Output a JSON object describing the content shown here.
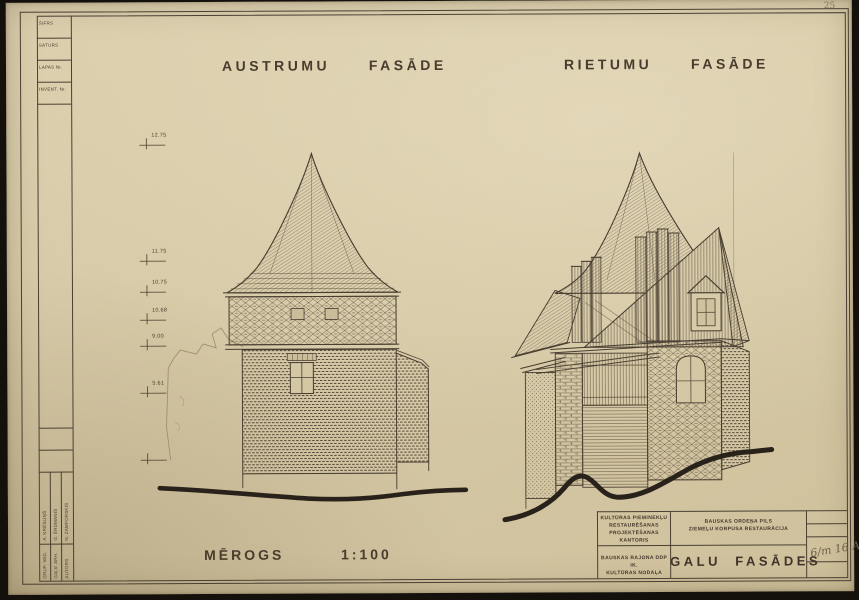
{
  "page": {
    "sheet_number": "25"
  },
  "colors": {
    "paper": "#d7cba9",
    "ink": "#46392b",
    "ground": "#29221a"
  },
  "corner_table": {
    "labels": [
      "ŠIFRS",
      "SATURS",
      "LAPAS Nr.",
      "INVENT. Nr."
    ]
  },
  "facade_titles": {
    "left": "AUSTRUMU  FASĀDE",
    "right": "RIETUMU  FASĀDE"
  },
  "scale_label": "MĒROGS   1:100",
  "elevations": [
    "12.75",
    "11.75",
    "10.75",
    "10.68",
    "9.00",
    "5.61"
  ],
  "title_block": {
    "office": "KULTŪRAS PIEMINEKĻU\nRESTAURĒŠANAS\nPROJEKTĒŠANAS\nKANTORIS",
    "project": "BAUSKAS  ORDEŅA  PILS\nZIEMEĻU KORPUSA RESTAURĀCIJA",
    "client": "BAUSKAS RAJONA DDP IK.\nKULTŪRAS NODAĻA",
    "sheet_title": "GALU  FASĀDES",
    "annotation": "6/m 16 A2"
  },
  "signatures": {
    "rows": [
      {
        "role": "GRUP. VAD.",
        "name": "A. KRĒSLIŅŠ"
      },
      {
        "role": "GALV. ARH.",
        "name": "G. ĒRDMANIS"
      },
      {
        "role": "AUTORS",
        "name": "N. ZAMPORSKIS"
      }
    ]
  }
}
